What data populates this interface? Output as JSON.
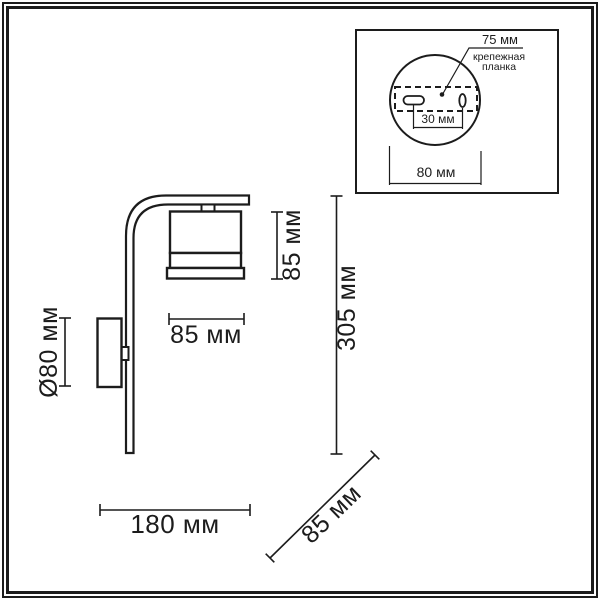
{
  "title": "Wall sconce dimensional drawing",
  "colors": {
    "line": "#1c1c1c",
    "background": "#ffffff"
  },
  "main_drawing": {
    "dimensions": {
      "shade_width": "85 мм",
      "shade_height": "85 мм",
      "overall_height": "305 мм",
      "backplate_diameter": "Ø80 мм",
      "overall_width": "180 мм",
      "overall_depth": "85 мм"
    }
  },
  "inset": {
    "hole_pitch": "75 мм",
    "bracket_label_line1": "крепежная",
    "bracket_label_line2": "планка",
    "slot_spacing": "30 мм",
    "backplate_width": "80 мм"
  }
}
